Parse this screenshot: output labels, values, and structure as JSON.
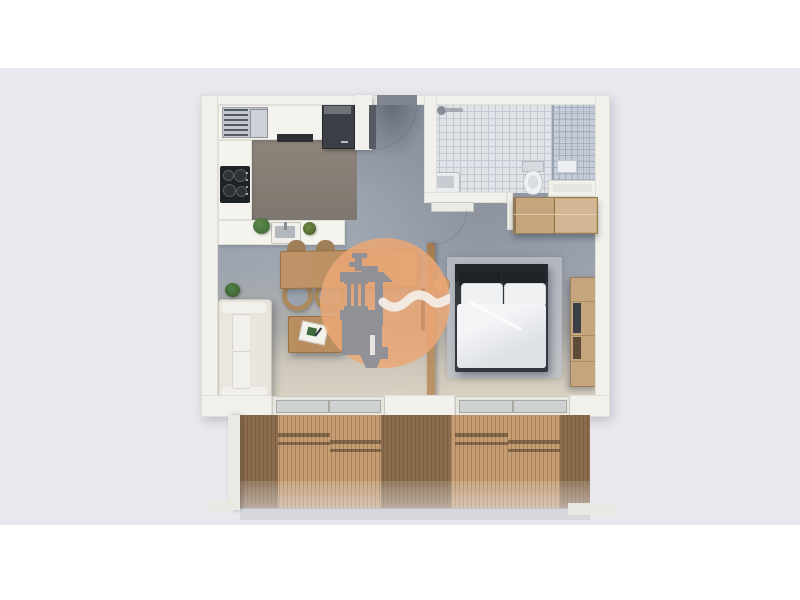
{
  "meta": {
    "type": "3d-floor-plan-render",
    "view": "top-down",
    "unit": "one-bedroom apartment with bathroom, open kitchen-living room and full-width balcony"
  },
  "colors": {
    "page-white": "#ffffff",
    "bg": "#e8e9ee",
    "wall": "#f1f0ea",
    "white-paint": "#f4f3ee",
    "floor": "#99a1ad",
    "floor-dark": "#7f8591",
    "floor-beige": "#d8d1c2",
    "floor-kitchen": "#857d74",
    "tile": "#dfe2e7",
    "tile-line": "#c2c7d0",
    "glass": "rgba(180,190,205,0.55)",
    "rug": "#b9bcc2",
    "deck": "#c69d72",
    "deck-line": "#a8805a",
    "deck-shadow": "rgba(66,50,36,0.45)",
    "sofa": "#e7e4dd",
    "sofa-cushion": "#f2f0ea",
    "wood": "#b98f62",
    "wood-light": "#c5a57e",
    "wood-edge": "#97713f",
    "bed-frame": "#33363c",
    "bed-head": "#24272c",
    "linen": "#eff1f3",
    "watermark-orange": "rgba(235,167,117,0.85)",
    "logo-gray": "#8a8f9a",
    "plant": "#46703c",
    "appliance": "#3c4046"
  },
  "rooms": [
    {
      "name": "kitchen",
      "fixtures": [
        "vented appliance",
        "fridge",
        "cooktop",
        "hob strip",
        "sink",
        "two plants",
        "L-shaped white counter"
      ]
    },
    {
      "name": "hallway",
      "fixtures": [
        "entrance door with swing arc"
      ]
    },
    {
      "name": "bathroom",
      "fixtures": [
        "shower head",
        "washbasin",
        "toilet",
        "glass shower enclosure",
        "shower tray",
        "door with swing arc"
      ]
    },
    {
      "name": "living-room",
      "fixtures": [
        "sofa",
        "floor plant",
        "dining table",
        "four chairs",
        "coffee table with book",
        "wall TV on partition"
      ]
    },
    {
      "name": "bedroom",
      "fixtures": [
        "double bed",
        "rug",
        "round side stool",
        "tall wooden media unit",
        "wardrobe"
      ]
    },
    {
      "name": "balcony",
      "fixtures": [
        "wooden deck",
        "two sliding glass doors",
        "glass railing",
        "side walls"
      ]
    }
  ],
  "watermark": {
    "name": "real-estate-watermark",
    "shape": "orange circle with gray lighthouse-tower logo and white wave"
  }
}
